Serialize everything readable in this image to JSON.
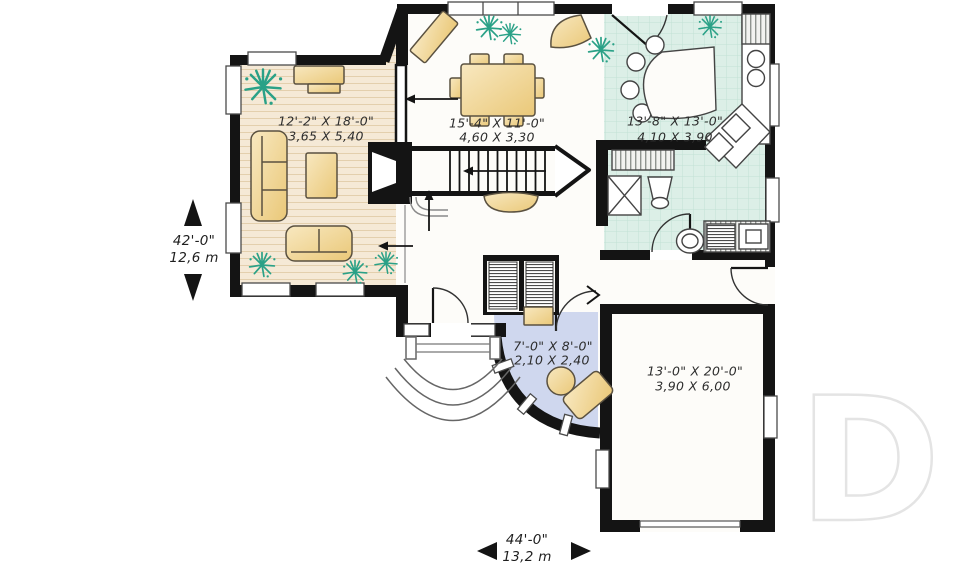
{
  "title": "House first floor plan",
  "rooms": {
    "living": {
      "name": "living room",
      "imperial": "12'-2\" X 18'-0\"",
      "metric": "3,65 X 5,40"
    },
    "dining": {
      "name": "dining room",
      "imperial": "15'-4\" X 11'-0\"",
      "metric": "4,60 X 3,30"
    },
    "kitchen": {
      "name": "kitchen",
      "imperial": "13'-8\" X 13'-0\"",
      "metric": "4,10 X 3,90"
    },
    "den": {
      "name": "den / office",
      "imperial": "7'-0\" X 8'-0\"",
      "metric": "2,10 X 2,40"
    },
    "garage": {
      "name": "garage",
      "imperial": "13'-0\" X 20'-0\"",
      "metric": "3,90 X 6,00"
    }
  },
  "overall_dimensions": {
    "depth": {
      "imperial": "42'-0\"",
      "metric": "12,6 m"
    },
    "width": {
      "imperial": "44'-0\"",
      "metric": "13,2 m"
    }
  },
  "watermark": {
    "letter": "D"
  },
  "colors": {
    "wall": "#141414",
    "wood_floor": "#f5e9d6",
    "tile_floor": "#dcefe7",
    "den_floor": "#cfd7ee",
    "furniture": "#f3dca4",
    "plant": "#2aa187",
    "watermark": "#e4e4e4"
  },
  "icons": [
    "sofa-icon",
    "loveseat-icon",
    "coffee-table-icon",
    "console-icon",
    "sideboard-icon",
    "dining-table-icon",
    "demilune-table-icon",
    "breakfast-table-icon",
    "stairs-icon",
    "fireplace-icon",
    "closet-icon",
    "toilet-icon",
    "pedestal-sink-icon",
    "washer-icon",
    "dryer-icon",
    "kitchen-sink-icon",
    "desk-icon",
    "desk-chair-icon",
    "plant-icon",
    "door-swing-icon",
    "porch-steps-icon",
    "dimension-arrow-icon"
  ]
}
